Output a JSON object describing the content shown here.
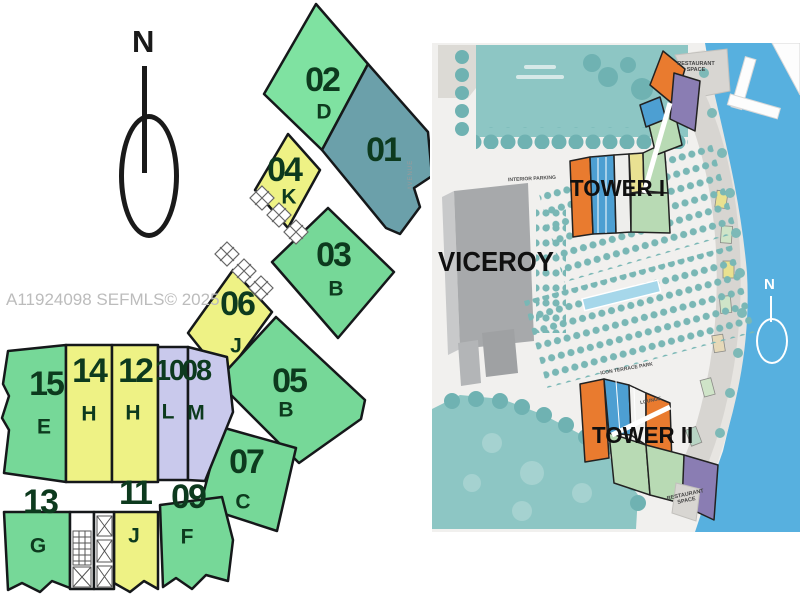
{
  "watermark": "A11924098  SEFMLS© 2025",
  "floorplan": {
    "compass": "N",
    "units": [
      {
        "number": "01",
        "letter": ""
      },
      {
        "number": "02",
        "letter": "D"
      },
      {
        "number": "03",
        "letter": "B"
      },
      {
        "number": "04",
        "letter": "K"
      },
      {
        "number": "05",
        "letter": "B"
      },
      {
        "number": "06",
        "letter": "J"
      },
      {
        "number": "07",
        "letter": "C"
      },
      {
        "number": "08",
        "letter": "M"
      },
      {
        "number": "09",
        "letter": "F"
      },
      {
        "number": "10",
        "letter": "L"
      },
      {
        "number": "11",
        "letter": "J"
      },
      {
        "number": "12",
        "letter": "H"
      },
      {
        "number": "13",
        "letter": "G"
      },
      {
        "number": "14",
        "letter": "H"
      },
      {
        "number": "15",
        "letter": "E"
      }
    ],
    "unit_colors": {
      "green": "#76d898",
      "teal": "#6ba0aa",
      "yellow": "#eef285",
      "lavender": "#c9c9ec"
    }
  },
  "siteplan": {
    "building_label": "VICEROY",
    "tower1_label": "TOWER I",
    "tower2_label": "TOWER II",
    "restaurant_label_line1": "RESTAURANT",
    "restaurant_label_line2": "SPACE",
    "terrace_park_label": "ICON TERRACE PARK",
    "lounge_label": "LOUNGE",
    "parking_label": "INTERIOR PARKING",
    "avenue_label": "AVENUE",
    "compass": "N",
    "water_color": "#57b0df",
    "park_color": "#8dc6c4",
    "accent_orange": "#e97b2f",
    "accent_blue": "#4d9fd2",
    "accent_purple": "#8a7db3"
  }
}
